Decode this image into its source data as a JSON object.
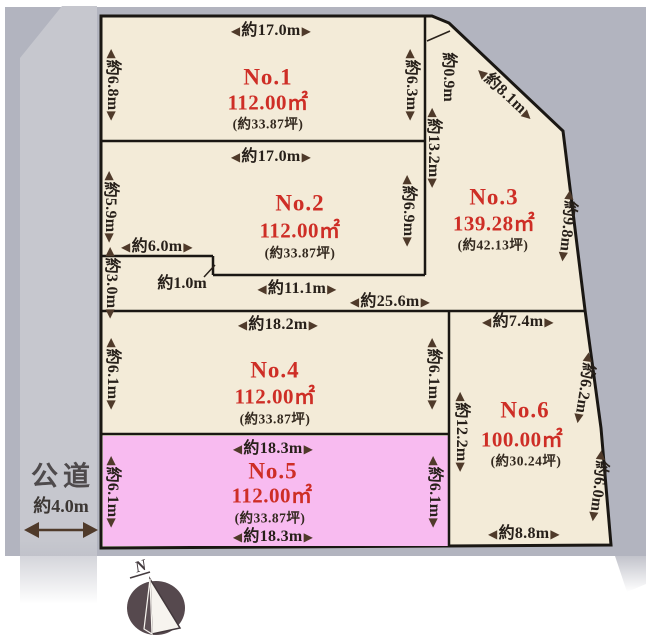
{
  "colors": {
    "background_gray": "#b2b4bf",
    "road_gray": "#c6c7ce",
    "parcel_beige": "#f3ebd8",
    "highlight_pink": "#f8bbf0",
    "boundary_black": "#1a1713",
    "accent_red": "#ce2e26",
    "arrow_brown": "#4f3a2a"
  },
  "road": {
    "name": "公道",
    "width": "約4.0m"
  },
  "compass": {
    "north": "N"
  },
  "mid_measures": {
    "left_width": "約6.0m",
    "step_height": "約3.0m",
    "step_offset": "約1.0m",
    "inner_width": "約11.1m",
    "total_width": "約25.6m"
  },
  "plots": [
    {
      "name": "No.1",
      "area": "112.00㎡",
      "tsubo": "(約33.87坪)",
      "top": "約17.0m",
      "left": "約6.8m",
      "right": "約6.3m"
    },
    {
      "name": "No.2",
      "area": "112.00㎡",
      "tsubo": "(約33.87坪)",
      "top": "約17.0m",
      "left": "約5.9m",
      "right": "約6.9m"
    },
    {
      "name": "No.3",
      "area": "139.28㎡",
      "tsubo": "(約42.13坪)",
      "left": "約13.2m",
      "right": "約9.8m",
      "top_edge": "約0.9m",
      "diagonal_edge": "約8.1m"
    },
    {
      "name": "No.4",
      "area": "112.00㎡",
      "tsubo": "(約33.87坪)",
      "top": "約18.2m",
      "left": "約6.1m",
      "right": "約6.1m"
    },
    {
      "name": "No.5",
      "area": "112.00㎡",
      "tsubo": "(約33.87坪)",
      "top": "約18.3m",
      "bottom": "約18.3m",
      "left": "約6.1m",
      "right": "約6.1m"
    },
    {
      "name": "No.6",
      "area": "100.00㎡",
      "tsubo": "(約30.24坪)",
      "top": "約7.4m",
      "left": "約12.2m",
      "right_upper": "約6.2m",
      "right_lower": "約6.0m",
      "bottom": "約8.8m"
    }
  ]
}
